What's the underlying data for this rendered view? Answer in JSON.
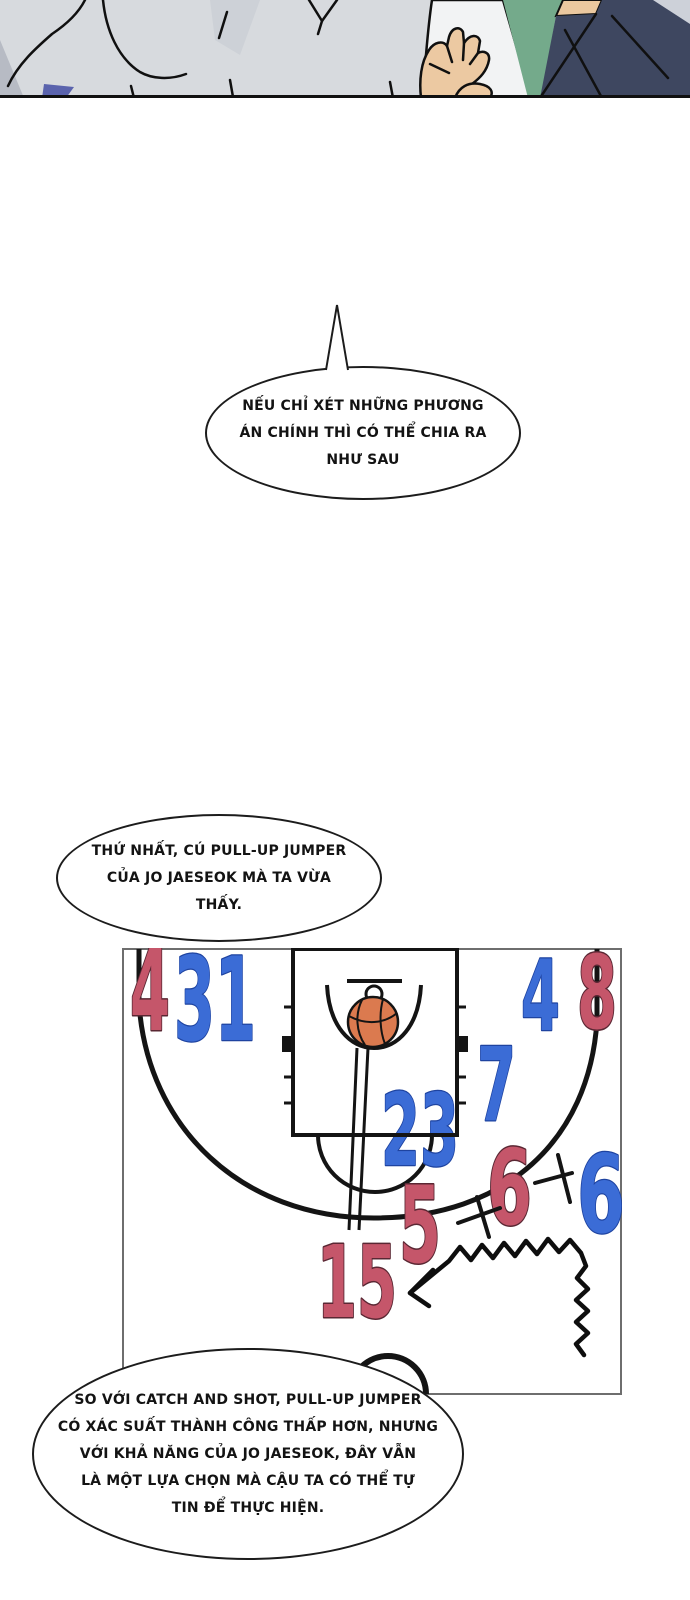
{
  "page": {
    "background": "#ffffff"
  },
  "panel": {
    "colors": {
      "fabric_gray": "#d7dade",
      "shade_gray": "#b7bbc4",
      "shirt_white": "#f2f3f4",
      "skin": "#ebc89f",
      "green_jacket": "#74aa8b",
      "navy_jacket": "#3e4760",
      "blue_patch": "#5a63ad"
    }
  },
  "bubbles": {
    "first": {
      "lines": [
        "NẾU CHỈ XÉT NHỮNG PHƯƠNG",
        "ÁN CHÍNH THÌ CÓ THỂ CHIA RA",
        "NHƯ SAU"
      ]
    },
    "second": {
      "lines": [
        "THỨ NHẤT, CÚ PULL-UP JUMPER",
        "CỦA JO JAESEOK MÀ TA VỪA",
        "THẤY."
      ]
    },
    "third": {
      "lines": [
        "SO VỚI CATCH AND SHOT, PULL-UP JUMPER",
        "CÓ XÁC SUẤT THÀNH CÔNG THẤP HƠN, NHƯNG",
        "VỚI KHẢ NĂNG CỦA JO JAESEOK, ĐÂY VẪN",
        "LÀ MỘT LỰA CHỌN MÀ CẬU TA CÓ THỂ TỰ",
        "TIN ĐỂ THỰC HIỆN."
      ]
    }
  },
  "court": {
    "colors": {
      "red_number": "#c5566a",
      "red_outline": "#5a2733",
      "blue_number": "#3b6cd6",
      "blue_outline": "#1e43a0",
      "ball": "#db7a4f",
      "line": "#141414",
      "border": "#6e6e6e"
    },
    "markers": [
      {
        "value": "4",
        "team": "red"
      },
      {
        "value": "31",
        "team": "blue"
      },
      {
        "value": "4",
        "team": "blue"
      },
      {
        "value": "8",
        "team": "red"
      },
      {
        "value": "7",
        "team": "blue"
      },
      {
        "value": "23",
        "team": "blue"
      },
      {
        "value": "6",
        "team": "red"
      },
      {
        "value": "6",
        "team": "blue"
      },
      {
        "value": "5",
        "team": "red"
      },
      {
        "value": "15",
        "team": "red"
      }
    ]
  }
}
